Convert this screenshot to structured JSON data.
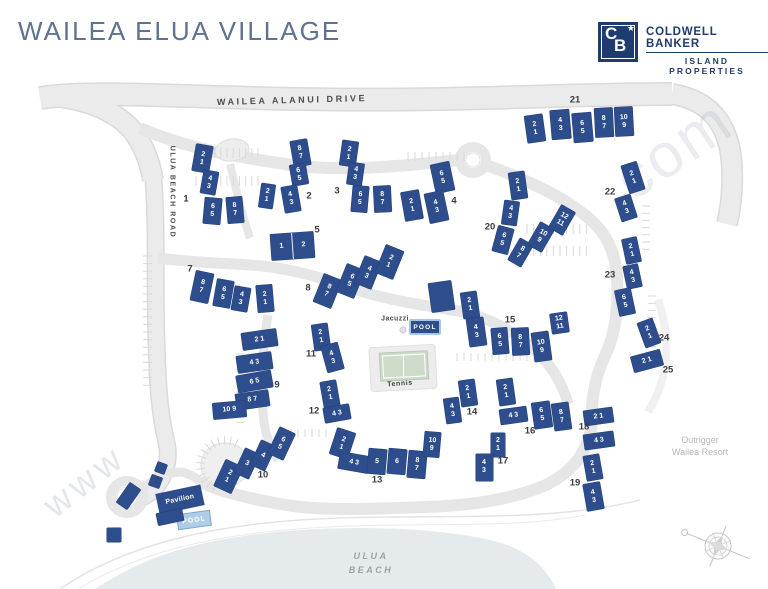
{
  "title": "WAILEA ELUA VILLAGE",
  "logo": {
    "mono_c": "C",
    "mono_b": "B",
    "star": "★",
    "line1": "COLDWELL BANKER",
    "line2": "ISLAND PROPERTIES"
  },
  "roads": {
    "main": "WAILEA ALANUI DRIVE",
    "side": "ULUA BEACH ROAD"
  },
  "amenities": {
    "jacuzzi": "Jacuzzi",
    "pool_main": "POOL",
    "tennis": "Tennis",
    "pavilion": "Pavilion",
    "pool_beach": "POOL"
  },
  "beach": {
    "line1": "ULUA",
    "line2": "BEACH"
  },
  "neighbor": {
    "line1": "Outrigger",
    "line2": "Wailea Resort"
  },
  "watermark": {
    "prefix": "www",
    "suffix": ".com"
  },
  "colors": {
    "building": "#2e4d8c",
    "logo_navy": "#1f3c6e",
    "title_blue": "#5e7292",
    "road_gray": "#ebebeb",
    "beach_gray": "#e5ebed",
    "pool_border_blue": "#a7c6e8"
  },
  "cluster_labels": [
    {
      "n": "1",
      "x": 186,
      "y": 199
    },
    {
      "n": "2",
      "x": 309,
      "y": 196
    },
    {
      "n": "3",
      "x": 337,
      "y": 191
    },
    {
      "n": "4",
      "x": 454,
      "y": 201
    },
    {
      "n": "5",
      "x": 317,
      "y": 230
    },
    {
      "n": "7",
      "x": 190,
      "y": 269
    },
    {
      "n": "8",
      "x": 308,
      "y": 288
    },
    {
      "n": "9",
      "x": 277,
      "y": 385
    },
    {
      "n": "10",
      "x": 263,
      "y": 475
    },
    {
      "n": "11",
      "x": 311,
      "y": 354
    },
    {
      "n": "12",
      "x": 314,
      "y": 411
    },
    {
      "n": "13",
      "x": 377,
      "y": 480
    },
    {
      "n": "14",
      "x": 472,
      "y": 412
    },
    {
      "n": "15",
      "x": 510,
      "y": 320
    },
    {
      "n": "16",
      "x": 530,
      "y": 431
    },
    {
      "n": "17",
      "x": 503,
      "y": 461
    },
    {
      "n": "18",
      "x": 584,
      "y": 427
    },
    {
      "n": "19",
      "x": 575,
      "y": 483
    },
    {
      "n": "20",
      "x": 490,
      "y": 227
    },
    {
      "n": "21",
      "x": 575,
      "y": 100
    },
    {
      "n": "22",
      "x": 610,
      "y": 192
    },
    {
      "n": "23",
      "x": 610,
      "y": 275
    },
    {
      "n": "24",
      "x": 664,
      "y": 338
    },
    {
      "n": "25",
      "x": 668,
      "y": 370
    }
  ],
  "buildings": [
    {
      "x": 202,
      "y": 158,
      "w": 17,
      "h": 27,
      "r": 10,
      "lines": [
        "2",
        "1"
      ]
    },
    {
      "x": 209,
      "y": 182,
      "w": 15,
      "h": 23,
      "r": 10,
      "lines": [
        "4",
        "3"
      ]
    },
    {
      "x": 212,
      "y": 211,
      "w": 17,
      "h": 26,
      "r": 5,
      "lines": [
        "6",
        "5"
      ]
    },
    {
      "x": 235,
      "y": 210,
      "w": 16,
      "h": 26,
      "r": -5,
      "lines": [
        "8",
        "7"
      ]
    },
    {
      "x": 300,
      "y": 153,
      "w": 17,
      "h": 26,
      "r": -10,
      "lines": [
        "8",
        "7"
      ]
    },
    {
      "x": 299,
      "y": 174,
      "w": 16,
      "h": 21,
      "r": -10,
      "lines": [
        "6",
        "5"
      ]
    },
    {
      "x": 267,
      "y": 196,
      "w": 14,
      "h": 24,
      "r": 8,
      "lines": [
        "2",
        "1"
      ]
    },
    {
      "x": 291,
      "y": 199,
      "w": 16,
      "h": 26,
      "r": -10,
      "lines": [
        "4",
        "3"
      ]
    },
    {
      "x": 349,
      "y": 153,
      "w": 16,
      "h": 25,
      "r": 8,
      "lines": [
        "2",
        "1"
      ]
    },
    {
      "x": 355,
      "y": 174,
      "w": 15,
      "h": 22,
      "r": 8,
      "lines": [
        "4",
        "3"
      ]
    },
    {
      "x": 360,
      "y": 199,
      "w": 16,
      "h": 26,
      "r": 5,
      "lines": [
        "6",
        "5"
      ]
    },
    {
      "x": 382,
      "y": 199,
      "w": 17,
      "h": 26,
      "r": -3,
      "lines": [
        "8",
        "7"
      ]
    },
    {
      "x": 442,
      "y": 177,
      "w": 19,
      "h": 29,
      "r": -12,
      "lines": [
        "6",
        "5"
      ]
    },
    {
      "x": 412,
      "y": 205,
      "w": 18,
      "h": 29,
      "r": -10,
      "lines": [
        "2",
        "1"
      ]
    },
    {
      "x": 436,
      "y": 207,
      "w": 19,
      "h": 30,
      "r": -12,
      "lines": [
        "4",
        "3"
      ]
    },
    {
      "x": 292,
      "y": 246,
      "w": 43,
      "h": 26,
      "r": -4,
      "lines": [
        "1",
        "2"
      ],
      "split": true
    },
    {
      "x": 202,
      "y": 287,
      "w": 18,
      "h": 30,
      "r": 12,
      "lines": [
        "8",
        "7"
      ]
    },
    {
      "x": 223,
      "y": 293,
      "w": 17,
      "h": 27,
      "r": 10,
      "lines": [
        "6",
        "5"
      ]
    },
    {
      "x": 241,
      "y": 299,
      "w": 16,
      "h": 24,
      "r": 10,
      "lines": [
        "4",
        "3"
      ]
    },
    {
      "x": 265,
      "y": 298,
      "w": 16,
      "h": 27,
      "r": -5,
      "lines": [
        "2",
        "1"
      ]
    },
    {
      "x": 327,
      "y": 291,
      "w": 19,
      "h": 30,
      "r": 22,
      "lines": [
        "8",
        "7"
      ]
    },
    {
      "x": 350,
      "y": 281,
      "w": 19,
      "h": 30,
      "r": 22,
      "lines": [
        "6",
        "5"
      ]
    },
    {
      "x": 368,
      "y": 272,
      "w": 18,
      "h": 29,
      "r": 22,
      "lines": [
        "4",
        "3"
      ]
    },
    {
      "x": 389,
      "y": 262,
      "w": 19,
      "h": 30,
      "r": 22,
      "lines": [
        "2",
        "1"
      ]
    },
    {
      "x": 259,
      "y": 339,
      "w": 35,
      "h": 17,
      "r": -8,
      "lines": [
        "2 1"
      ]
    },
    {
      "x": 254,
      "y": 362,
      "w": 35,
      "h": 17,
      "r": -8,
      "lines": [
        "4 3"
      ]
    },
    {
      "x": 254,
      "y": 381,
      "w": 35,
      "h": 17,
      "r": -10,
      "lines": [
        "6 5"
      ]
    },
    {
      "x": 252,
      "y": 400,
      "w": 33,
      "h": 16,
      "r": -8,
      "lines": [
        "8 7"
      ]
    },
    {
      "x": 229,
      "y": 410,
      "w": 33,
      "h": 16,
      "r": -5,
      "lines": [
        "10 9"
      ]
    },
    {
      "x": 228,
      "y": 476,
      "w": 19,
      "h": 29,
      "r": 25,
      "lines": [
        "2",
        "1"
      ]
    },
    {
      "x": 247,
      "y": 463,
      "w": 16,
      "h": 27,
      "r": 25,
      "lines": [
        "3"
      ]
    },
    {
      "x": 263,
      "y": 455,
      "w": 16,
      "h": 27,
      "r": 25,
      "lines": [
        "4"
      ]
    },
    {
      "x": 281,
      "y": 443,
      "w": 17,
      "h": 29,
      "r": 25,
      "lines": [
        "6",
        "5"
      ]
    },
    {
      "x": 321,
      "y": 337,
      "w": 16,
      "h": 26,
      "r": -8,
      "lines": [
        "2",
        "1"
      ]
    },
    {
      "x": 332,
      "y": 357,
      "w": 17,
      "h": 27,
      "r": -15,
      "lines": [
        "4",
        "3"
      ]
    },
    {
      "x": 330,
      "y": 394,
      "w": 16,
      "h": 26,
      "r": -10,
      "lines": [
        "2",
        "1"
      ]
    },
    {
      "x": 337,
      "y": 413,
      "w": 26,
      "h": 15,
      "r": -10,
      "lines": [
        "4 3"
      ]
    },
    {
      "x": 342,
      "y": 443,
      "w": 19,
      "h": 27,
      "r": 18,
      "lines": [
        "2",
        "1"
      ]
    },
    {
      "x": 354,
      "y": 462,
      "w": 30,
      "h": 17,
      "r": 10,
      "lines": [
        "4 3"
      ]
    },
    {
      "x": 377,
      "y": 461,
      "w": 18,
      "h": 25,
      "r": 5,
      "lines": [
        "5"
      ]
    },
    {
      "x": 397,
      "y": 461,
      "w": 18,
      "h": 25,
      "r": 5,
      "lines": [
        "6"
      ]
    },
    {
      "x": 417,
      "y": 464,
      "w": 18,
      "h": 27,
      "r": 5,
      "lines": [
        "8",
        "7"
      ]
    },
    {
      "x": 432,
      "y": 444,
      "w": 16,
      "h": 25,
      "r": 5,
      "lines": [
        "10",
        "9"
      ]
    },
    {
      "x": 468,
      "y": 393,
      "w": 16,
      "h": 26,
      "r": -8,
      "lines": [
        "2",
        "1"
      ]
    },
    {
      "x": 452,
      "y": 410,
      "w": 15,
      "h": 25,
      "r": -8,
      "lines": [
        "4",
        "3"
      ]
    },
    {
      "x": 470,
      "y": 305,
      "w": 16,
      "h": 26,
      "r": -8,
      "lines": [
        "2",
        "1"
      ]
    },
    {
      "x": 476,
      "y": 332,
      "w": 17,
      "h": 28,
      "r": -8,
      "lines": [
        "4",
        "3"
      ]
    },
    {
      "x": 500,
      "y": 341,
      "w": 16,
      "h": 26,
      "r": -5,
      "lines": [
        "6",
        "5"
      ]
    },
    {
      "x": 520,
      "y": 341,
      "w": 17,
      "h": 27,
      "r": -3,
      "lines": [
        "8",
        "7"
      ]
    },
    {
      "x": 541,
      "y": 346,
      "w": 17,
      "h": 29,
      "r": -8,
      "lines": [
        "10",
        "9"
      ]
    },
    {
      "x": 559,
      "y": 323,
      "w": 17,
      "h": 20,
      "r": -8,
      "lines": [
        "12",
        "11"
      ]
    },
    {
      "x": 506,
      "y": 392,
      "w": 16,
      "h": 26,
      "r": -8,
      "lines": [
        "2",
        "1"
      ]
    },
    {
      "x": 513,
      "y": 415,
      "w": 27,
      "h": 15,
      "r": -8,
      "lines": [
        "4 3"
      ]
    },
    {
      "x": 542,
      "y": 415,
      "w": 18,
      "h": 26,
      "r": -8,
      "lines": [
        "6",
        "5"
      ]
    },
    {
      "x": 561,
      "y": 416,
      "w": 17,
      "h": 27,
      "r": -8,
      "lines": [
        "8",
        "7"
      ]
    },
    {
      "x": 498,
      "y": 445,
      "w": 14,
      "h": 24,
      "r": 0,
      "lines": [
        "2",
        "1"
      ]
    },
    {
      "x": 484,
      "y": 467,
      "w": 17,
      "h": 27,
      "r": 0,
      "lines": [
        "4",
        "3"
      ]
    },
    {
      "x": 598,
      "y": 416,
      "w": 29,
      "h": 15,
      "r": -8,
      "lines": [
        "2 1"
      ]
    },
    {
      "x": 599,
      "y": 440,
      "w": 30,
      "h": 15,
      "r": -8,
      "lines": [
        "4 3"
      ]
    },
    {
      "x": 593,
      "y": 467,
      "w": 16,
      "h": 25,
      "r": -10,
      "lines": [
        "2",
        "1"
      ]
    },
    {
      "x": 593,
      "y": 496,
      "w": 17,
      "h": 27,
      "r": -10,
      "lines": [
        "4",
        "3"
      ]
    },
    {
      "x": 518,
      "y": 185,
      "w": 16,
      "h": 27,
      "r": -8,
      "lines": [
        "2",
        "1"
      ]
    },
    {
      "x": 510,
      "y": 213,
      "w": 15,
      "h": 24,
      "r": 8,
      "lines": [
        "4",
        "3"
      ]
    },
    {
      "x": 503,
      "y": 240,
      "w": 16,
      "h": 26,
      "r": 15,
      "lines": [
        "6",
        "5"
      ]
    },
    {
      "x": 520,
      "y": 252,
      "w": 15,
      "h": 25,
      "r": 30,
      "lines": [
        "8",
        "7"
      ]
    },
    {
      "x": 541,
      "y": 237,
      "w": 16,
      "h": 26,
      "r": 30,
      "lines": [
        "10",
        "9"
      ]
    },
    {
      "x": 562,
      "y": 220,
      "w": 16,
      "h": 26,
      "r": 30,
      "lines": [
        "12",
        "11"
      ]
    },
    {
      "x": 535,
      "y": 128,
      "w": 18,
      "h": 27,
      "r": -8,
      "lines": [
        "2",
        "1"
      ]
    },
    {
      "x": 560,
      "y": 124,
      "w": 19,
      "h": 29,
      "r": -5,
      "lines": [
        "4",
        "3"
      ]
    },
    {
      "x": 582,
      "y": 127,
      "w": 19,
      "h": 29,
      "r": -5,
      "lines": [
        "6",
        "5"
      ]
    },
    {
      "x": 604,
      "y": 122,
      "w": 18,
      "h": 29,
      "r": -3,
      "lines": [
        "8",
        "7"
      ]
    },
    {
      "x": 624,
      "y": 121,
      "w": 18,
      "h": 29,
      "r": -3,
      "lines": [
        "10",
        "9"
      ]
    },
    {
      "x": 633,
      "y": 177,
      "w": 16,
      "h": 29,
      "r": -18,
      "lines": [
        "2",
        "1"
      ]
    },
    {
      "x": 626,
      "y": 208,
      "w": 16,
      "h": 24,
      "r": -18,
      "lines": [
        "4",
        "3"
      ]
    },
    {
      "x": 631,
      "y": 250,
      "w": 15,
      "h": 25,
      "r": -12,
      "lines": [
        "2",
        "1"
      ]
    },
    {
      "x": 632,
      "y": 276,
      "w": 15,
      "h": 23,
      "r": -12,
      "lines": [
        "4",
        "3"
      ]
    },
    {
      "x": 625,
      "y": 302,
      "w": 16,
      "h": 26,
      "r": -12,
      "lines": [
        "6",
        "5"
      ]
    },
    {
      "x": 649,
      "y": 333,
      "w": 16,
      "h": 26,
      "r": -20,
      "lines": [
        "2",
        "1"
      ]
    },
    {
      "x": 647,
      "y": 361,
      "w": 30,
      "h": 16,
      "r": -15,
      "lines": [
        "2 1"
      ]
    },
    {
      "x": 441,
      "y": 296,
      "w": 23,
      "h": 29,
      "r": -8,
      "lines": []
    },
    {
      "x": 128,
      "y": 496,
      "w": 13,
      "h": 24,
      "r": 35,
      "lines": []
    },
    {
      "x": 155,
      "y": 481,
      "w": 11,
      "h": 11,
      "r": 20,
      "lines": []
    },
    {
      "x": 161,
      "y": 468,
      "w": 10,
      "h": 10,
      "r": 20,
      "lines": []
    },
    {
      "x": 170,
      "y": 517,
      "w": 26,
      "h": 12,
      "r": -12,
      "lines": []
    },
    {
      "x": 114,
      "y": 535,
      "w": 14,
      "h": 14,
      "r": 0,
      "lines": []
    }
  ]
}
